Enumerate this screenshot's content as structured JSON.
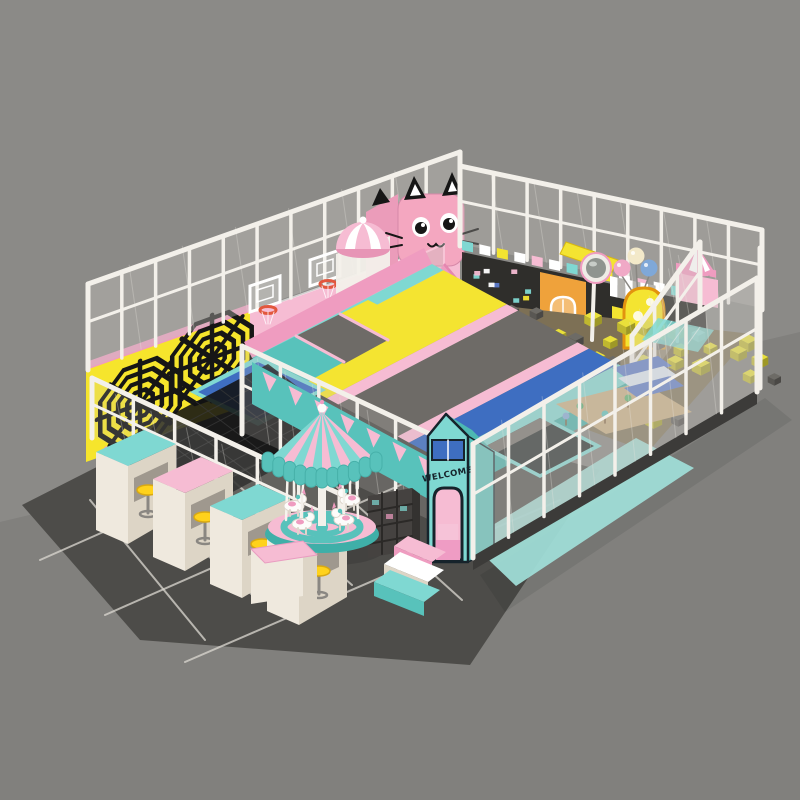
{
  "colors": {
    "background": "#8b8a87",
    "floor_outer": "#7f7e7b",
    "floor_dark": "#4d4c49",
    "tile_line": "#dcd9d1",
    "fence_white": "#f3f0ea",
    "mesh_light": "#c9c6c0",
    "mesh_dark": "#22211f",
    "pink": "#ef9cc0",
    "pink_light": "#f6bcd3",
    "pink_deep": "#e487b0",
    "mint": "#7fd8d2",
    "mint_dark": "#58c2bb",
    "mint_deep": "#3fafa8",
    "yellow": "#f4e431",
    "web_yellow": "#f6e52c",
    "web_black": "#161616",
    "blue": "#3e6ec1",
    "blue_steps": "#5b79c9",
    "gray_pad": "#6e6b67",
    "orange": "#efa23b",
    "cream": "#efe9de",
    "cream_dark": "#ddd5c6",
    "stool_yellow": "#ffd21c",
    "cat_pink": "#f4a7c0",
    "cube_yellow": "#e9e03a",
    "cube_gray": "#6d6b66",
    "balloon_pink": "#f0a9c6",
    "balloon_cream": "#f3e9c9",
    "balloon_blue": "#7fa8d8",
    "sphere_blue": "#b9cfe6",
    "sand": "#c9ad80",
    "pit_ground": "#7d7055",
    "outline_dark": "#16232b",
    "white": "#ffffff"
  },
  "text": {
    "welcome": "WELCOME"
  },
  "counts": {
    "spider_webs": 2,
    "basketball_hoops": 2,
    "tables": 4,
    "stools": 4,
    "balloons": 3,
    "carousel_horses": 4,
    "entry_steps": 3,
    "slides": 1
  }
}
